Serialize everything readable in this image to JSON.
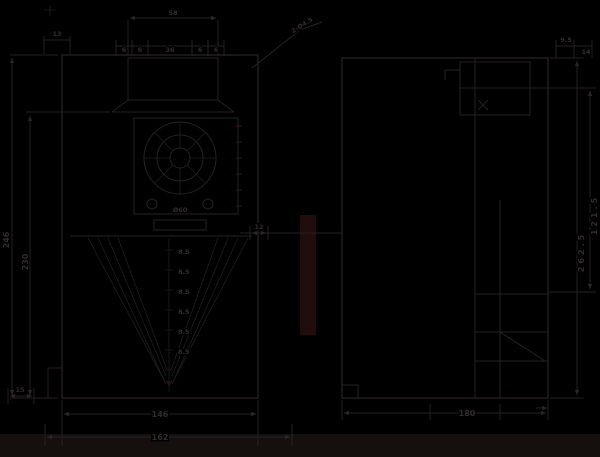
{
  "drawing": {
    "type": "engineering-dimension-drawing",
    "views": {
      "front": "front view",
      "side": "side view"
    }
  },
  "colors": {
    "background": "#000000",
    "line": "#262122",
    "line_strong": "#2b2526",
    "dim_text": "#332c2e",
    "accent_red": "#3a1719",
    "bottom_band": "#15100d"
  },
  "dims": {
    "front_top": [
      "6",
      "6",
      "36",
      "6",
      "6"
    ],
    "front_top_left": "13",
    "screen_width": "58",
    "front_height_outer": "246",
    "front_height_inner": "230",
    "grille_diameter": "Ø60",
    "center_steps": [
      "8.5",
      "8.5",
      "8.5",
      "8.5",
      "8.5",
      "8.5"
    ],
    "front_bottom_inner": "146",
    "front_bottom_outer": "162",
    "front_bottom_left": "15",
    "between_views": "12",
    "note_top_right": "2-Ø4.5",
    "side_top_right_a": "9.5",
    "side_top_right_b": "14",
    "side_height": "262.5",
    "side_height_inner": "121.5",
    "side_bottom_width": "180"
  }
}
